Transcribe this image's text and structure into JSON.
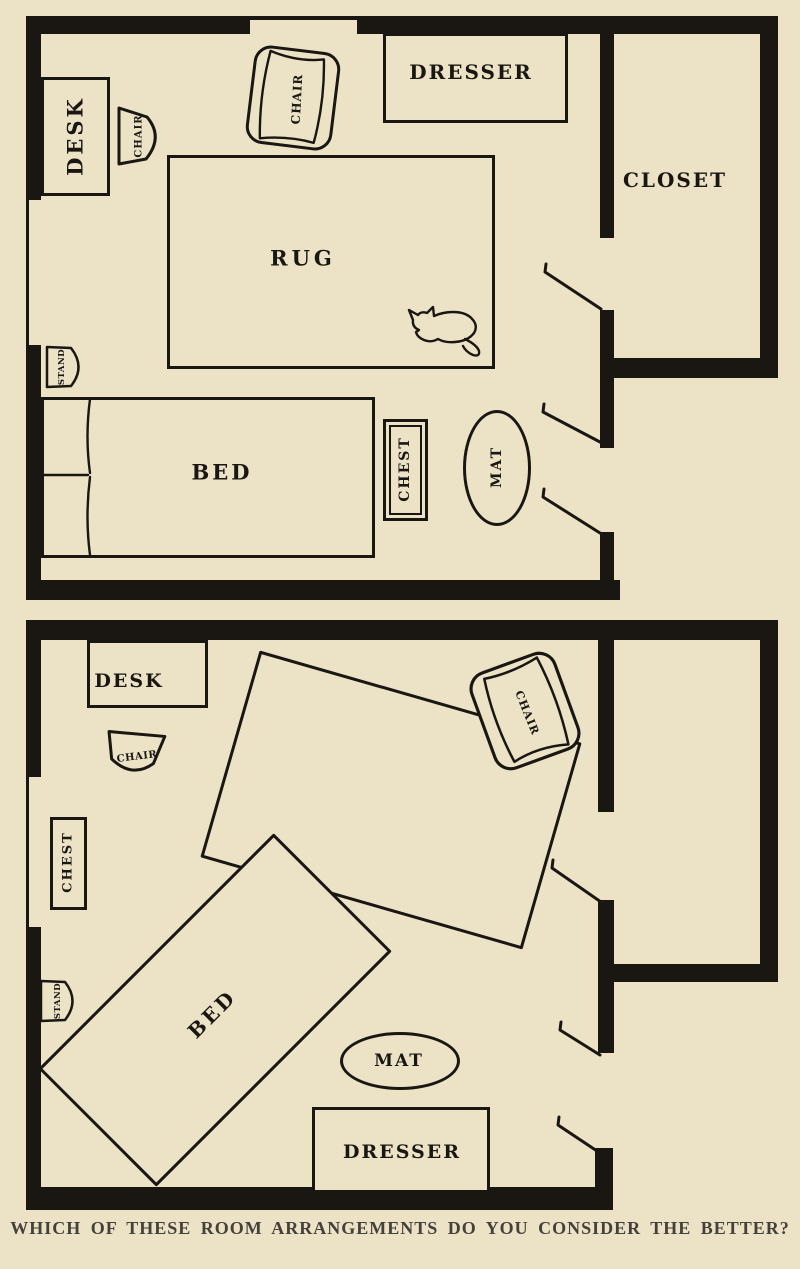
{
  "caption": "WHICH OF THESE ROOM ARRANGEMENTS DO YOU CONSIDER THE BETTER?",
  "colors": {
    "paper": "#ece2c6",
    "ink": "#1a1612",
    "caption_ink": "#45403a"
  },
  "icons": {
    "cat": "cat-silhouette-top-view",
    "door_swing": "door-swing-line",
    "window": "window-opening-gap"
  },
  "plans": {
    "top": {
      "desk": "DESK",
      "chair_small": "CHAIR",
      "chair_large": "CHAIR",
      "dresser": "DRESSER",
      "closet": "CLOSET",
      "rug": "RUG",
      "stand": "STAND",
      "bed": "BED",
      "chest": "CHEST",
      "mat": "MAT"
    },
    "bottom": {
      "desk": "DESK",
      "chair_small": "CHAIR",
      "chair_large": "CHAIR",
      "chest": "CHEST",
      "stand": "STAND",
      "bed": "BED",
      "mat": "MAT",
      "dresser": "DRESSER"
    }
  }
}
